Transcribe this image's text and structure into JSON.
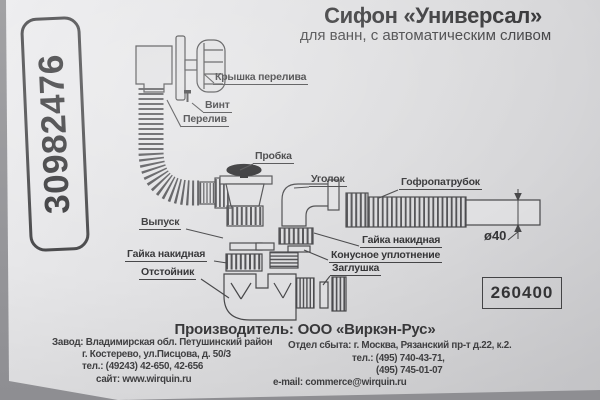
{
  "colors": {
    "paper": "#dcdcde",
    "ink": "#3b3b3d",
    "background": "#98989a"
  },
  "badge": {
    "number": "30982476"
  },
  "header": {
    "title": "Сифон «Универсал»",
    "subtitle": "для ванн, с автоматическим сливом"
  },
  "diagram": {
    "labels": {
      "overflow_cap": "Крышка перелива",
      "screw": "Винт",
      "overflow": "Перелив",
      "plug": "Пробка",
      "elbow": "Уголок",
      "corrugated_pipe": "Гофропатрубок",
      "outlet": "Выпуск",
      "union_nut_left": "Гайка накидная",
      "sump": "Отстойник",
      "union_nut_right": "Гайка накидная",
      "cone_seal": "Конусное уплотнение",
      "cap": "Заглушка"
    },
    "dimension": "ø40",
    "product_code": "260400"
  },
  "footer": {
    "manufacturer": "Производитель: ООО «Виркэн-Рус»",
    "factory_line1": "Завод: Владимирская обл. Петушинский район",
    "factory_line2": "г. Костерево, ул.Писцова, д. 50/3",
    "factory_line3": "тел.: (49243) 42-650, 42-656",
    "factory_line4": "сайт: www.wirquin.ru",
    "sales_line1": "Отдел сбыта: г. Москва, Рязанский пр-т д.22, к.2.",
    "sales_line2": "тел.: (495) 740-43-71,",
    "sales_line3": "(495) 745-01-07",
    "sales_line4": "e-mail: commerce@wirquin.ru"
  }
}
